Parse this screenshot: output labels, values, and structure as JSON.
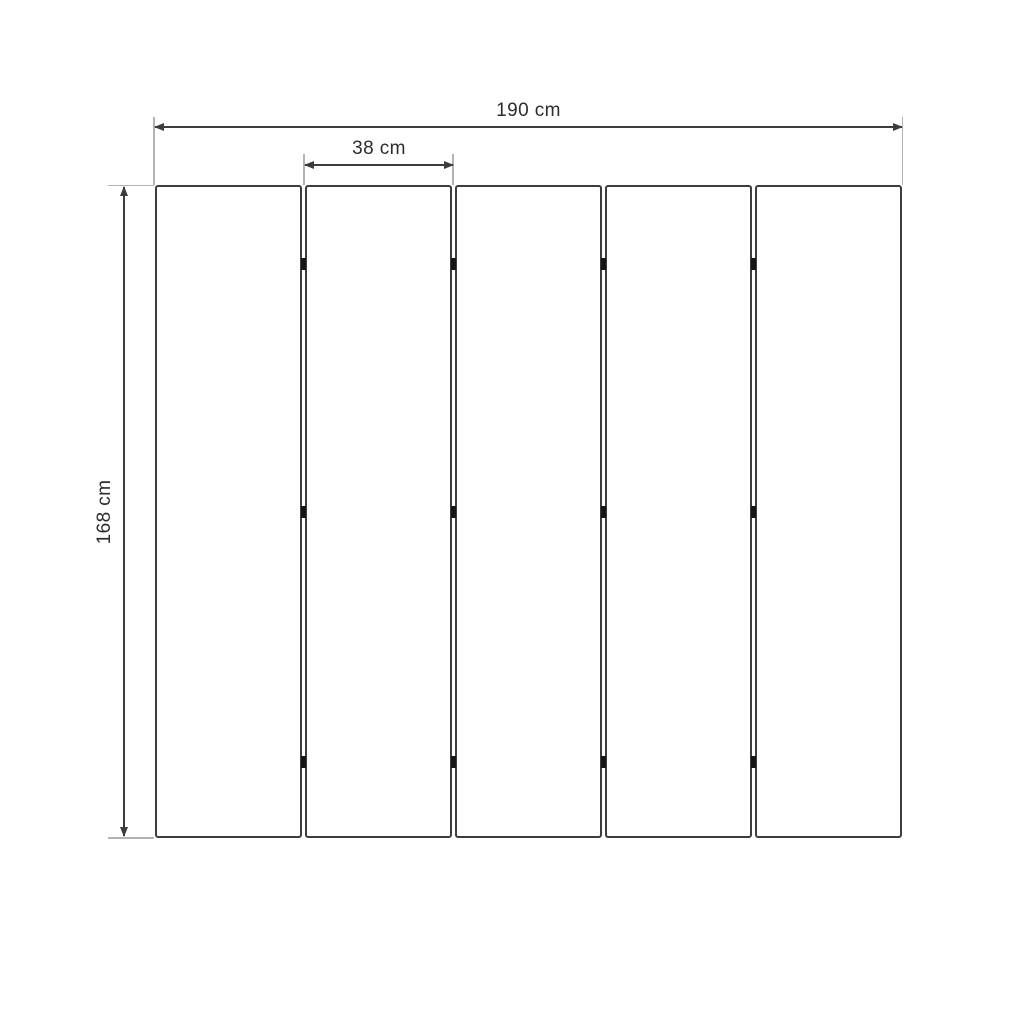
{
  "diagram": {
    "labels": {
      "total_width": "190 cm",
      "panel_width": "38 cm",
      "height": "168 cm"
    },
    "panel_count": 5,
    "gap_count": 4,
    "hinges_per_gap": 3,
    "colors": {
      "background": "#ffffff",
      "line": "#3d3d3d",
      "extension_line": "#b3b3b3",
      "hinge": "#161616",
      "text": "#2d2d2d"
    }
  }
}
